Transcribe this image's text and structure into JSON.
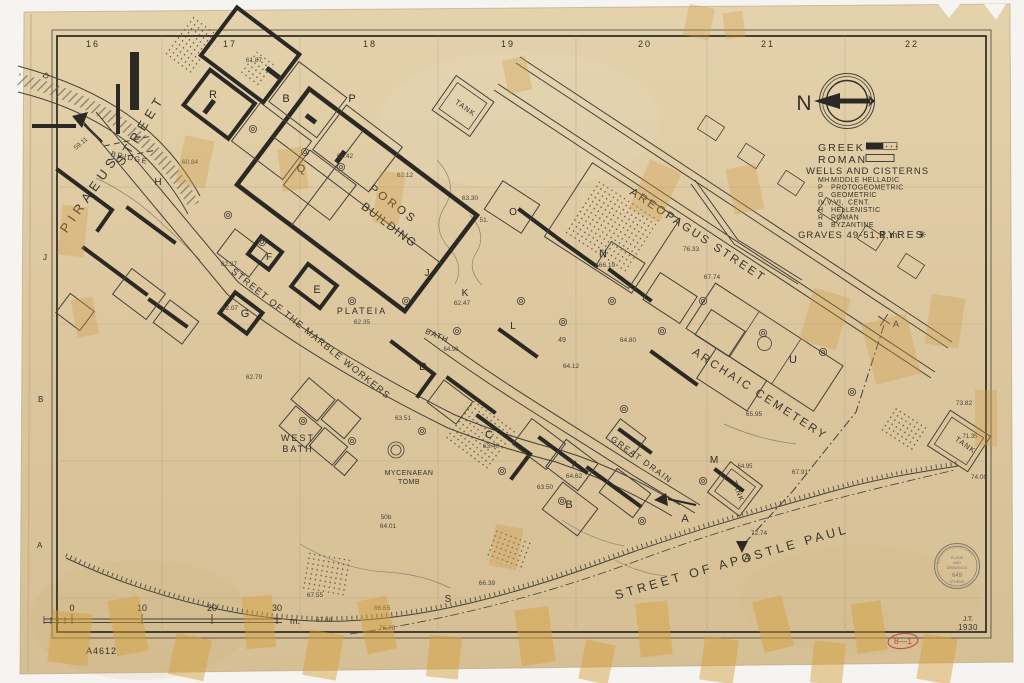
{
  "colors": {
    "paper": "#dcc69e",
    "ink": "#33312b",
    "tape": "#cf9d45",
    "red_ink": "#c0453c",
    "photo_bg": "#f5f4f1"
  },
  "compass": {
    "label": "N"
  },
  "grid": {
    "columns": [
      "16",
      "17",
      "18",
      "19",
      "20",
      "21",
      "22"
    ],
    "rows": [
      "D",
      "J",
      "B",
      "A"
    ]
  },
  "legend": {
    "entries": [
      {
        "label": "GREEK",
        "swatch": "solid-and-stippled"
      },
      {
        "label": "ROMAN",
        "swatch": "outline"
      }
    ],
    "wells_title": "WELLS AND CISTERNS",
    "abbreviations": [
      {
        "code": "MH",
        "label": "MIDDLE HELLADIC"
      },
      {
        "code": "P",
        "label": "PROTOGEOMETRIC"
      },
      {
        "code": "G",
        "label": "GEOMETRIC"
      },
      {
        "code": "IV,V,VI,",
        "label": "CENT."
      },
      {
        "code": "H",
        "label": "HELLENISTIC"
      },
      {
        "code": "R",
        "label": "ROMAN"
      },
      {
        "code": "B",
        "label": "BYZANTINE"
      }
    ],
    "graves_note": "GRAVES 49-51,8,m.",
    "pyres_label": "PYRES",
    "pyres_symbol": "✳"
  },
  "scale_bar": {
    "ticks": [
      "0",
      "10",
      "20",
      "30"
    ],
    "unit": "m."
  },
  "title_block": {
    "drawing_number": "A4612",
    "initials": "J.T.",
    "year": "1930",
    "red_mark": "8—1"
  },
  "stamp": {
    "arc_top": "AGORA EXCAVATIONS",
    "line1": "PLANS",
    "line2": "AND",
    "line3": "DRAWINGS",
    "number": "649",
    "bottom": "ATHENS"
  },
  "map_labels": [
    {
      "name": "street-piraeus",
      "text": "PIRAEUS",
      "x": 93,
      "y": 196,
      "rot": -55,
      "size": 13,
      "ls": 5,
      "cls": "street"
    },
    {
      "name": "street-piraeus-2",
      "text": "STREET",
      "x": 144,
      "y": 132,
      "rot": -58,
      "size": 13,
      "ls": 5,
      "cls": "street"
    },
    {
      "name": "bridge-label",
      "text": "BRIDGE",
      "x": 129,
      "y": 160,
      "rot": 12,
      "size": 7.5,
      "ls": 1.5,
      "cls": "street"
    },
    {
      "name": "street-marble-workers",
      "text": "STREET OF THE MARBLE WORKERS",
      "x": 309,
      "y": 336,
      "rot": 39,
      "size": 9.5,
      "ls": 1.2,
      "cls": "street"
    },
    {
      "name": "street-areopagus",
      "text": "AREOPAGUS STREET",
      "x": 696,
      "y": 238,
      "rot": 33.5,
      "size": 11.5,
      "ls": 2.5,
      "cls": "street"
    },
    {
      "name": "archaic-cemetery-label",
      "text": "ARCHAIC CEMETERY",
      "x": 758,
      "y": 397,
      "rot": 33,
      "size": 11.5,
      "ls": 2.5,
      "cls": "street"
    },
    {
      "name": "great-drain-label",
      "text": "GREAT DRAIN",
      "x": 640,
      "y": 462,
      "rot": 36,
      "size": 8.5,
      "ls": 1.5,
      "cls": "street"
    },
    {
      "name": "street-apostle-paul",
      "text": "STREET OF APOSTLE PAUL",
      "x": 733,
      "y": 566,
      "rot": -16,
      "size": 12.5,
      "ls": 3.5,
      "cls": "street"
    },
    {
      "name": "poros-building-1",
      "text": "POROS",
      "x": 391,
      "y": 207,
      "rot": 37,
      "size": 11.5,
      "ls": 3,
      "cls": "bld"
    },
    {
      "name": "poros-building-2",
      "text": "BUILDING",
      "x": 387,
      "y": 228,
      "rot": 37,
      "size": 11.5,
      "ls": 1.5,
      "cls": "bld"
    },
    {
      "name": "plateia-label",
      "text": "PLATEIA",
      "x": 362,
      "y": 314,
      "size": 9,
      "ls": 2,
      "cls": "bld"
    },
    {
      "name": "plateia-elev",
      "text": "62.35",
      "x": 362,
      "y": 324,
      "size": 6.5,
      "cls": "elev"
    },
    {
      "name": "bath-label",
      "text": "BATH",
      "x": 436,
      "y": 338,
      "rot": 23,
      "size": 8,
      "ls": 1,
      "cls": "bld"
    },
    {
      "name": "bath-elev",
      "text": "64.96",
      "x": 451,
      "y": 351,
      "size": 6,
      "cls": "elev"
    },
    {
      "name": "west-bath-1",
      "text": "WEST",
      "x": 298,
      "y": 441,
      "size": 9,
      "ls": 2,
      "cls": "bld"
    },
    {
      "name": "west-bath-2",
      "text": "BATH",
      "x": 298,
      "y": 452,
      "size": 9,
      "ls": 2,
      "cls": "bld"
    },
    {
      "name": "mycenaean-tomb-1",
      "text": "MYCENAEAN",
      "x": 409,
      "y": 475,
      "size": 7,
      "ls": 0.5,
      "cls": "bld"
    },
    {
      "name": "mycenaean-tomb-2",
      "text": "TOMB",
      "x": 409,
      "y": 484,
      "size": 7,
      "ls": 0.5,
      "cls": "bld"
    },
    {
      "name": "tank-top-label",
      "text": "TANK",
      "x": 464,
      "y": 110,
      "rot": 35,
      "size": 7.5,
      "ls": 1,
      "cls": "bld"
    },
    {
      "name": "tank-mid-label",
      "text": "TANK",
      "x": 736,
      "y": 492,
      "rot": 68,
      "size": 7,
      "ls": 1,
      "cls": "bld"
    },
    {
      "name": "tank-right-label",
      "text": "TANK",
      "x": 964,
      "y": 447,
      "rot": 35,
      "size": 7.5,
      "ls": 1,
      "cls": "bld"
    },
    {
      "name": "section-r",
      "text": "R",
      "x": 213,
      "y": 98,
      "size": 11,
      "cls": "sec"
    },
    {
      "name": "section-b-upper",
      "text": "B",
      "x": 286,
      "y": 102,
      "size": 11,
      "cls": "sec"
    },
    {
      "name": "section-p",
      "text": "P",
      "x": 352,
      "y": 102,
      "size": 11,
      "cls": "sec"
    },
    {
      "name": "section-q",
      "text": "Q",
      "x": 301,
      "y": 172,
      "size": 11,
      "cls": "sec"
    },
    {
      "name": "section-h",
      "text": "H",
      "x": 158,
      "y": 185,
      "size": 10,
      "cls": "sec"
    },
    {
      "name": "section-f",
      "text": "F",
      "x": 269,
      "y": 260,
      "size": 10,
      "cls": "sec"
    },
    {
      "name": "section-e",
      "text": "E",
      "x": 317,
      "y": 293,
      "size": 11,
      "cls": "sec"
    },
    {
      "name": "section-g",
      "text": "G",
      "x": 245,
      "y": 317,
      "size": 11,
      "cls": "sec"
    },
    {
      "name": "section-j",
      "text": "J",
      "x": 427,
      "y": 276,
      "size": 10,
      "cls": "sec"
    },
    {
      "name": "section-k",
      "text": "K",
      "x": 465,
      "y": 296,
      "size": 10,
      "cls": "sec"
    },
    {
      "name": "section-l",
      "text": "L",
      "x": 513,
      "y": 329,
      "size": 10,
      "cls": "sec"
    },
    {
      "name": "section-d",
      "text": "D",
      "x": 423,
      "y": 370,
      "size": 11,
      "cls": "sec"
    },
    {
      "name": "section-c",
      "text": "C",
      "x": 489,
      "y": 438,
      "size": 11,
      "cls": "sec"
    },
    {
      "name": "section-n",
      "text": "N",
      "x": 603,
      "y": 257,
      "size": 11,
      "cls": "sec"
    },
    {
      "name": "section-o",
      "text": "O",
      "x": 513,
      "y": 215,
      "size": 10,
      "cls": "sec"
    },
    {
      "name": "section-t",
      "text": "T",
      "x": 573,
      "y": 468,
      "size": 10,
      "cls": "sec"
    },
    {
      "name": "section-b-lower",
      "text": "B",
      "x": 569,
      "y": 508,
      "size": 11,
      "cls": "sec"
    },
    {
      "name": "section-u",
      "text": "U",
      "x": 793,
      "y": 363,
      "size": 11,
      "cls": "sec"
    },
    {
      "name": "section-m",
      "text": "M",
      "x": 714,
      "y": 463,
      "size": 10,
      "cls": "sec"
    },
    {
      "name": "section-a",
      "text": "A",
      "x": 685,
      "y": 522,
      "size": 11,
      "cls": "sec"
    },
    {
      "name": "section-s",
      "text": "S",
      "x": 448,
      "y": 602,
      "size": 10,
      "cls": "sec"
    },
    {
      "name": "section-marker-a-top",
      "text": "A",
      "x": 896,
      "y": 327,
      "size": 9,
      "cls": "sec"
    },
    {
      "name": "section-marker-a-bottom",
      "text": "A",
      "x": 747,
      "y": 561,
      "size": 9,
      "cls": "sec"
    },
    {
      "name": "elev-6187",
      "text": "61.87",
      "x": 254,
      "y": 62,
      "size": 6.5,
      "cls": "elev"
    },
    {
      "name": "elev-6142",
      "text": "61.42",
      "x": 345,
      "y": 158,
      "size": 6.5,
      "cls": "elev"
    },
    {
      "name": "elev-6212",
      "text": "62.12",
      "x": 405,
      "y": 177,
      "size": 6.5,
      "cls": "elev"
    },
    {
      "name": "elev-6330",
      "text": "63.30",
      "x": 470,
      "y": 200,
      "size": 6.5,
      "cls": "elev"
    },
    {
      "name": "elev-51",
      "text": "51.",
      "x": 484,
      "y": 222,
      "size": 6.5,
      "cls": "elev"
    },
    {
      "name": "elev-6084",
      "text": "60.84",
      "x": 190,
      "y": 164,
      "size": 6.5,
      "cls": "elev"
    },
    {
      "name": "elev-5911",
      "text": "59.11",
      "x": 82,
      "y": 145,
      "rot": -40,
      "size": 6.5,
      "cls": "elev"
    },
    {
      "name": "elev-6227",
      "text": "62.27",
      "x": 229,
      "y": 266,
      "size": 6.5,
      "cls": "elev"
    },
    {
      "name": "elev-6207",
      "text": "62.07",
      "x": 230,
      "y": 310,
      "size": 6.5,
      "cls": "elev"
    },
    {
      "name": "elev-6279",
      "text": "62.79",
      "x": 254,
      "y": 379,
      "size": 6.5,
      "cls": "elev"
    },
    {
      "name": "elev-6247",
      "text": "62.47",
      "x": 462,
      "y": 305,
      "size": 6.5,
      "cls": "elev"
    },
    {
      "name": "elev-6351",
      "text": "63.51",
      "x": 403,
      "y": 420,
      "size": 6.5,
      "cls": "elev"
    },
    {
      "name": "elev-6340",
      "text": "63.40",
      "x": 491,
      "y": 448,
      "size": 6.5,
      "cls": "elev"
    },
    {
      "name": "elev-6412",
      "text": "64.12",
      "x": 571,
      "y": 368,
      "size": 6.5,
      "cls": "elev"
    },
    {
      "name": "elev-6480",
      "text": "64.80",
      "x": 628,
      "y": 342,
      "size": 6.5,
      "cls": "elev"
    },
    {
      "name": "elev-49",
      "text": "49",
      "x": 562,
      "y": 342,
      "size": 7,
      "cls": "elev"
    },
    {
      "name": "elev-6619",
      "text": "66.19",
      "x": 607,
      "y": 267,
      "size": 6.5,
      "cls": "elev"
    },
    {
      "name": "elev-6595",
      "text": "65.95",
      "x": 754,
      "y": 416,
      "size": 6.5,
      "cls": "elev"
    },
    {
      "name": "elev-7633",
      "text": "76.33",
      "x": 691,
      "y": 251,
      "size": 6.5,
      "cls": "elev"
    },
    {
      "name": "elev-6774",
      "text": "67.74",
      "x": 712,
      "y": 279,
      "size": 6.5,
      "cls": "elev"
    },
    {
      "name": "elev-6791",
      "text": "67.91",
      "x": 800,
      "y": 474,
      "size": 6.5,
      "cls": "elev"
    },
    {
      "name": "elev-6495",
      "text": "64.95",
      "x": 745,
      "y": 468,
      "size": 6,
      "cls": "elev"
    },
    {
      "name": "elev-7274",
      "text": "72.74",
      "x": 759,
      "y": 535,
      "size": 6.5,
      "cls": "elev"
    },
    {
      "name": "elev-7382",
      "text": "73.82",
      "x": 964,
      "y": 405,
      "size": 6.5,
      "cls": "elev"
    },
    {
      "name": "elev-7135",
      "text": "71.35",
      "x": 970,
      "y": 438,
      "size": 6,
      "cls": "elev"
    },
    {
      "name": "elev-7400",
      "text": "74.00",
      "x": 979,
      "y": 479,
      "size": 6.5,
      "cls": "elev"
    },
    {
      "name": "elev-6639",
      "text": "66.39",
      "x": 487,
      "y": 585,
      "size": 6.5,
      "cls": "elev"
    },
    {
      "name": "elev-6665",
      "text": "66.65",
      "x": 382,
      "y": 610,
      "size": 6.5,
      "cls": "elev"
    },
    {
      "name": "elev-7678",
      "text": "76.78",
      "x": 387,
      "y": 630,
      "size": 6.5,
      "cls": "elev"
    },
    {
      "name": "elev-6755",
      "text": "67.55",
      "x": 315,
      "y": 597,
      "size": 6.5,
      "cls": "elev"
    },
    {
      "name": "elev-6768",
      "text": "67.68",
      "x": 324,
      "y": 622,
      "size": 6.5,
      "cls": "elev"
    },
    {
      "name": "elev-6350b",
      "text": "63.50",
      "x": 545,
      "y": 489,
      "size": 6.5,
      "cls": "elev"
    },
    {
      "name": "elev-6462",
      "text": "64.62",
      "x": 574,
      "y": 478,
      "size": 6.5,
      "cls": "elev"
    },
    {
      "name": "elev-50b",
      "text": "50b",
      "x": 386,
      "y": 519,
      "size": 6.5,
      "cls": "elev"
    },
    {
      "name": "elev-6401",
      "text": "64.01",
      "x": 388,
      "y": 528,
      "size": 6.5,
      "cls": "elev"
    }
  ]
}
